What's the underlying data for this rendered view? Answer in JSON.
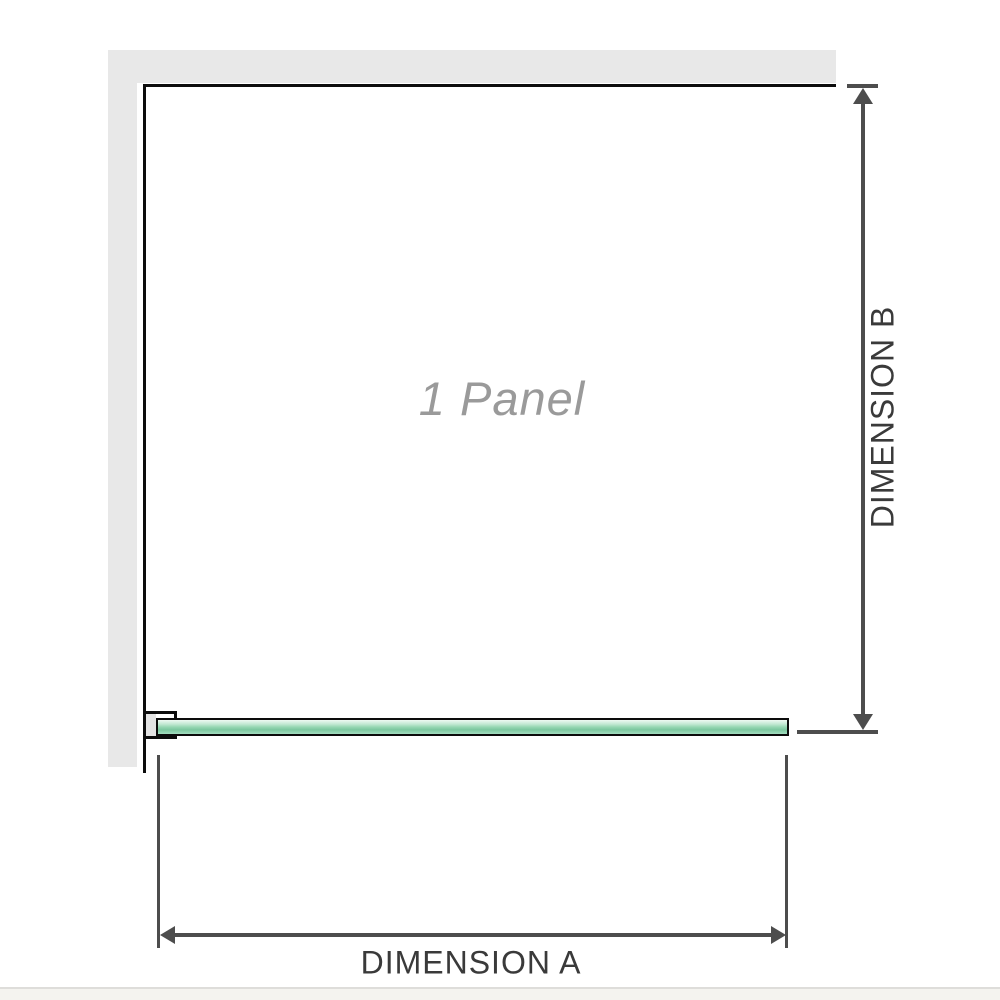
{
  "diagram": {
    "panel_label": "1 Panel",
    "dimension_a": {
      "label": "DIMENSION A"
    },
    "dimension_b": {
      "label": "DIMENSION B"
    }
  },
  "colors": {
    "background": "#ffffff",
    "wall_fill": "#e8e8e8",
    "outline": "#0c0c0c",
    "dimension_line": "#4d4d4d",
    "dimension_text": "#3a3a3a",
    "panel_label_text": "#9a9a9a",
    "glass_green_light": "#c4e9d4",
    "glass_green_dark": "#7cc79f",
    "footer_band": "#f4f3ef"
  }
}
